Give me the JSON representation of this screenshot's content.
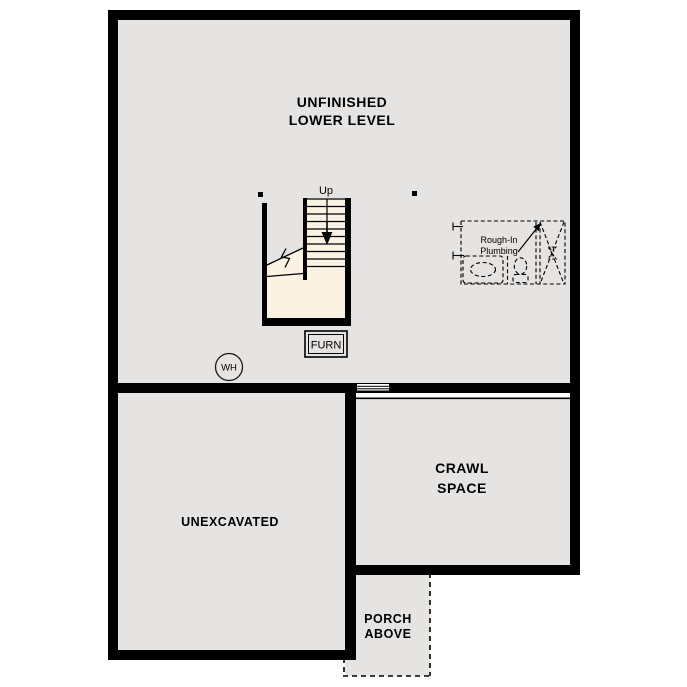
{
  "plan": {
    "colors": {
      "wall": "#000000",
      "room_fill": "#e5e4e2",
      "stair_fill": "#faf2e3",
      "line": "#000000",
      "background": "#ffffff"
    },
    "rooms": {
      "lower_level": {
        "label_line1": "UNFINISHED",
        "label_line2": "LOWER LEVEL"
      },
      "unexcavated": {
        "label": "UNEXCAVATED"
      },
      "crawl_space": {
        "label_line1": "CRAWL",
        "label_line2": "SPACE"
      },
      "porch": {
        "label_line1": "PORCH",
        "label_line2": "ABOVE"
      }
    },
    "annotations": {
      "up": "Up",
      "furnace": "FURN",
      "water_heater": "WH",
      "rough_in_line1": "Rough-In",
      "rough_in_line2": "Plumbing"
    }
  }
}
